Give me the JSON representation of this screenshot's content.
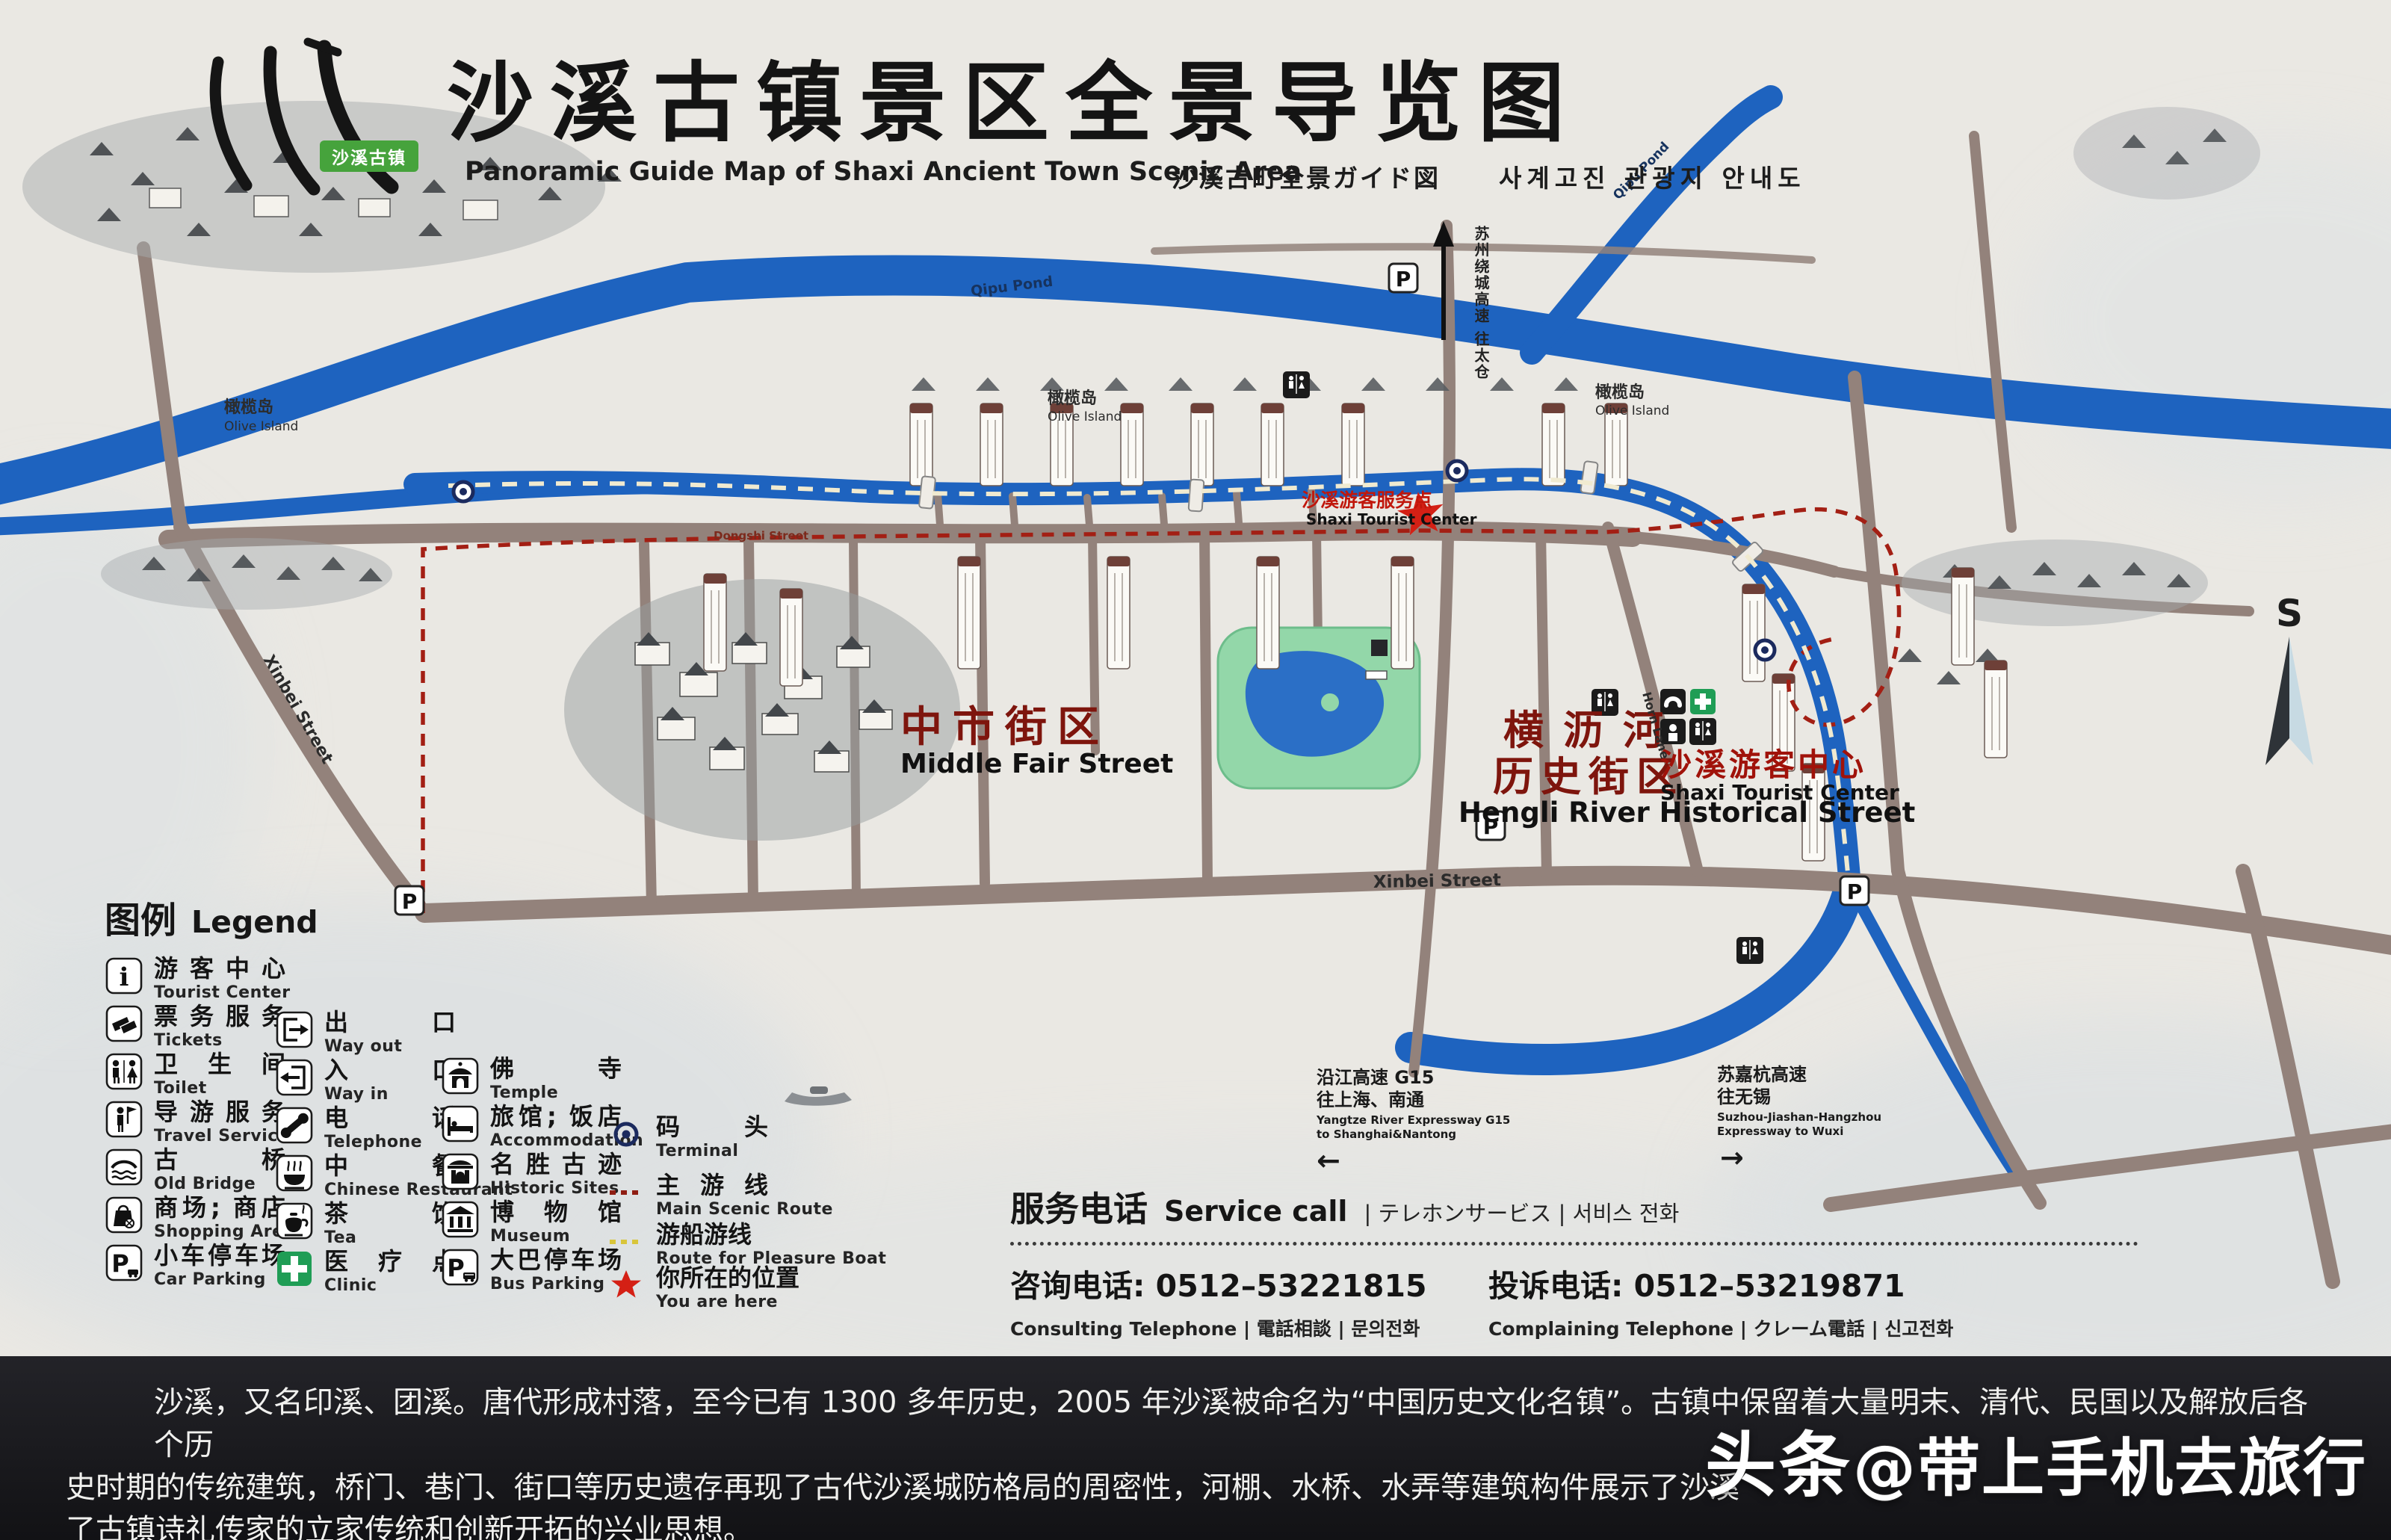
{
  "header": {
    "badge": "沙溪古镇",
    "title": "沙溪古镇景区全景导览图",
    "subtitle_en": "Panoramic Guide Map of Shaxi Ancient Town Scenic Area",
    "subtitle_ja": "沙溪古町全景ガイド図",
    "subtitle_ko": "사계고진 관광지 안내도"
  },
  "icons": {
    "parking_glyph": "P",
    "info_glyph": "i"
  },
  "map": {
    "compass": "S",
    "river_label": "Qipu Pond",
    "island_zh": "橄榄岛",
    "island_en": "Olive Island",
    "area_middle_zh": "中市街区",
    "area_middle_en": "Middle Fair Street",
    "hengli_zh1": "横沥河",
    "hengli_zh2": "历史街区",
    "hengli_en": "Hengli River Historical Street",
    "tc_zh": "沙溪游客中心",
    "tc_en": "Shaxi Tourist Center",
    "star_zh": "沙溪游客服务点",
    "star_en": "Shaxi Tourist Center",
    "st_xinbei": "Xinbei Street",
    "st_dongshi": "Dongshi Street",
    "st_horn": "Horn Lane",
    "north_zh": "苏州绕城高速 往太仓",
    "g15": {
      "zh1": "沿江高速 G15",
      "zh2": "往上海、南通",
      "en1": "Yangtze River Expressway G15",
      "en2": "to Shanghai&Nantong",
      "arrow": "←"
    },
    "sjh": {
      "zh1": "苏嘉杭高速",
      "zh2": "往无锡",
      "en1": "Suzhou-Jiashan-Hangzhou",
      "en2": "Expressway to Wuxi",
      "arrow": "→"
    }
  },
  "legend": {
    "title_zh": "图例",
    "title_en": "Legend",
    "col1": [
      {
        "zh": "游客中心",
        "en": "Tourist Center"
      },
      {
        "zh": "票务服务",
        "en": "Tickets"
      },
      {
        "zh": "卫生间",
        "en": "Toilet"
      },
      {
        "zh": "导游服务",
        "en": "Travel Service"
      },
      {
        "zh": "古桥",
        "en": "Old Bridge"
      },
      {
        "zh": "商场; 商店",
        "en": "Shopping Area"
      },
      {
        "zh": "小车停车场",
        "en": "Car Parking"
      }
    ],
    "col2": [
      {
        "zh": "出口",
        "en": "Way out"
      },
      {
        "zh": "入口",
        "en": "Way in"
      },
      {
        "zh": "电话",
        "en": "Telephone"
      },
      {
        "zh": "中餐",
        "en": "Chinese Restaurant"
      },
      {
        "zh": "茶饮",
        "en": "Tea"
      },
      {
        "zh": "医疗点",
        "en": "Clinic"
      }
    ],
    "col3": [
      {
        "zh": "佛寺",
        "en": "Temple"
      },
      {
        "zh": "旅馆; 饭店",
        "en": "Accommodation"
      },
      {
        "zh": "名胜古迹",
        "en": "Historic Sites"
      },
      {
        "zh": "博物馆",
        "en": "Museum"
      },
      {
        "zh": "大巴停车场",
        "en": "Bus Parking"
      }
    ],
    "col4": [
      {
        "zh": "码头",
        "en": "Terminal"
      },
      {
        "zh": "主游线",
        "en": "Main Scenic Route"
      },
      {
        "zh": "游船游线",
        "en": "Route for Pleasure Boat"
      },
      {
        "zh": "你所在的位置",
        "en": "You are here"
      }
    ]
  },
  "service": {
    "title_zh": "服务电话",
    "title_en": "Service call",
    "title_other": "| テレホンサービス | 서비스 전화",
    "consult": "咨询电话: 0512–53221815",
    "consult_sub": "Consulting Telephone | 電話相談 | 문의전화",
    "complain": "投诉电话: 0512–53219871",
    "complain_sub": "Complaining Telephone | クレーム電話 | 신고전화"
  },
  "footer": {
    "line1": "沙溪，又名印溪、团溪。唐代形成村落，至今已有 1300 多年历史，2005 年沙溪被命名为“中国历史文化名镇”。古镇中保留着大量明末、清代、民国以及解放后各个历",
    "line2": "史时期的传统建筑，桥门、巷门、街口等历史遗存再现了古代沙溪城防格局的周密性，河棚、水桥、水弄等建筑构件展示了沙溪",
    "line3": "了古镇诗礼传家的立家传统和创新开拓的兴业思想。",
    "wm1": "头条",
    "wm2": "@带上手机去旅行"
  },
  "colors": {
    "river_blue": "#1e63bf",
    "road_gray": "#93827b",
    "route_red": "#a31f14",
    "label_red": "#7e150d",
    "clinic_green": "#1f9d55",
    "star_red": "#d42015",
    "board_bg": "#eae8e3",
    "footer_bg": "#1a1a1f"
  }
}
